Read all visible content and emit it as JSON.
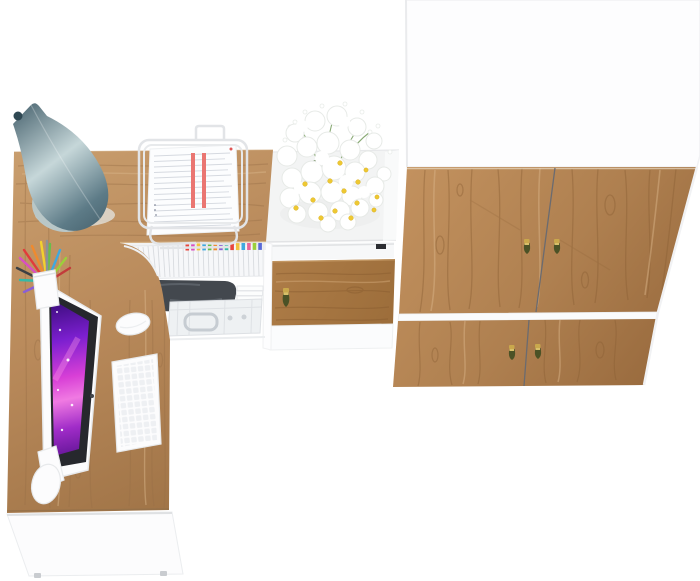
{
  "scene": {
    "description": "Top-down 3D product render of a home office furniture set: L-shaped oak desk with raised hutch and accessories, oak side cabinet with white daisy bouquet, and a two-tier oak wardrobe with tasseled keys.",
    "view": "top-down render, no text",
    "items": [
      "l-shaped-desk",
      "desk-hutch",
      "table-lamp",
      "document-stand",
      "paper-stack",
      "pencil-cup",
      "monitor",
      "keyboard",
      "mouse",
      "magazine-shelf",
      "camera-bag",
      "briefcase",
      "book-stack",
      "side-cabinet",
      "daisy-bouquet",
      "drawer-key",
      "wardrobe",
      "wardrobe-keys"
    ]
  },
  "colors": {
    "background": "#ffffff",
    "deskWoodLight": "#c99e6e",
    "deskWood": "#b8895a",
    "deskWoodDark": "#a07447",
    "wardrobeWoodLight": "#c3925f",
    "wardrobeWood": "#af8050",
    "wardrobeWoodDark": "#936539",
    "drawerWood": "#ae7d48",
    "drawerWoodDark": "#9c6d3a",
    "panelWhite": "#fcfcfd",
    "panelEdge": "#e9ebed",
    "cabinetTop": "#f3f4f4",
    "lampLight": "#c6d7d9",
    "lampMid": "#5d7b87",
    "lampDark": "#46616d",
    "lampBase": "#b9c7c7",
    "screenDeep": "#30096e",
    "screenPurple": "#7c1fd0",
    "screenMagenta": "#d83fd6",
    "screenPink": "#f07ae2",
    "screenViolet": "#a02cc8",
    "screenBottom": "#58118e",
    "bezel": "#26282d",
    "keyGold": "#c9a84c",
    "tasselDark": "#4b5226",
    "daisyCenter": "#eec832",
    "leafGreen": "#7ca065",
    "paperLine": "#c9ced6",
    "redStripe": "#ea7672",
    "bagDark": "#43484e",
    "briefcase": "#eef1f3",
    "notch": "#2c2e32",
    "keyboardKeys": "#eef0f3"
  },
  "magazines": {
    "tabs": [
      "#e8453c",
      "#d94fc3",
      "#f2c23e",
      "#3fa8e0",
      "#67bf4a",
      "#ef8a2e",
      "#8a5fd6",
      "#36b9a6",
      "#e8453c",
      "#f2c23e",
      "#3fa8e0",
      "#e8649a",
      "#9ccf3a",
      "#5a6bd8"
    ]
  },
  "pencilCup": {
    "penColors": [
      "#e23b3b",
      "#ef8a2e",
      "#f2d12e",
      "#67bf4a",
      "#3fa8e0",
      "#d94fc3",
      "#3c4043",
      "#36b9a6",
      "#8a5fd6",
      "#9ccf3a",
      "#c23b3b",
      "#8b9298"
    ]
  }
}
